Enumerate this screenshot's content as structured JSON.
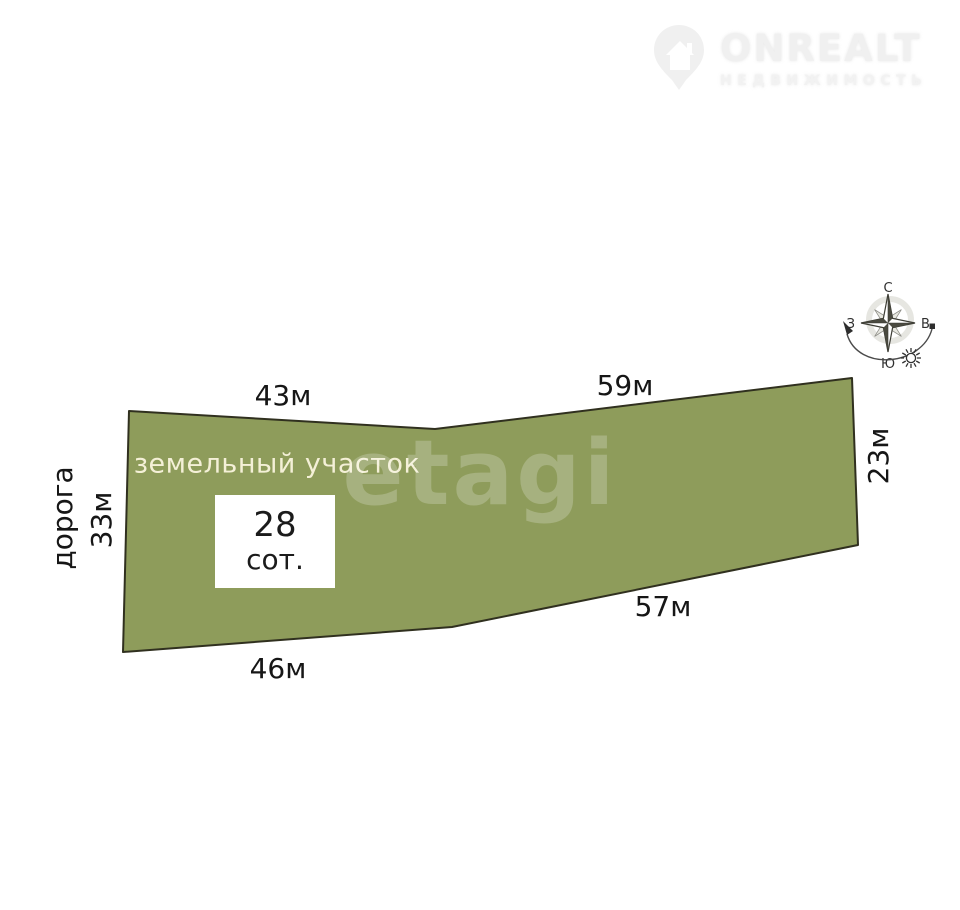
{
  "brand": {
    "name": "ONREALT",
    "subtitle": "НЕДВИЖИМОСТЬ"
  },
  "watermark": {
    "text": "etagi"
  },
  "plot": {
    "title": "земельный участок",
    "area": {
      "value": "28",
      "unit": "сот."
    },
    "polygon_points": "129,411 435,429 852,378 858,545 452,627 123,652",
    "dimensions": {
      "top_left": "43м",
      "top_right": "59м",
      "right": "23м",
      "bottom_right": "57м",
      "bottom_left": "46м",
      "left": "33м"
    },
    "road": "дорога"
  },
  "compass": {
    "north": "С",
    "south": "Ю",
    "east": "В",
    "west": "З"
  },
  "colors": {
    "plot_fill": "#8e9c5b",
    "plot_stroke": "#30301f",
    "dimension_text": "#161616",
    "plot_title_text": "#f4f0d7",
    "area_box_bg": "#ffffff",
    "logo_text": "#f0f0f0"
  }
}
